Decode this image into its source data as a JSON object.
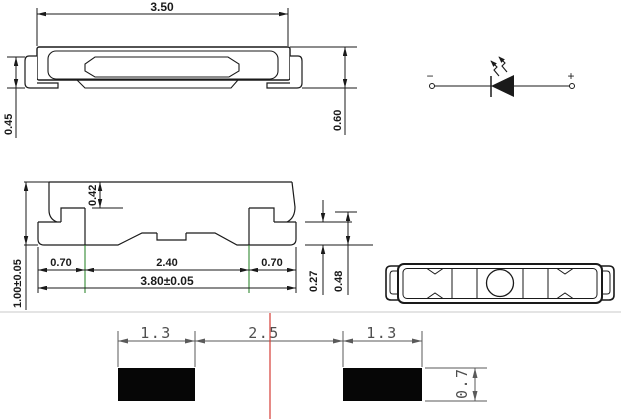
{
  "colors": {
    "line": "#1a1a1a",
    "dim_gray": "#5a5a5a",
    "red_centerline": "#d63c35",
    "green_extension": "#1e7d1e",
    "divider_gray": "#c9c9c9",
    "pad_black": "#060606",
    "background": "#ffffff"
  },
  "side_view": {
    "width": "3.50",
    "lead_height": "0.45",
    "total_height": "0.60"
  },
  "schematic": {
    "cathode_sign": "−",
    "anode_sign": "+"
  },
  "cross_section": {
    "step_depth": "0.42",
    "overall_height": "1.00±0.05",
    "left_lead": "0.70",
    "center_span": "2.40",
    "right_lead": "0.70",
    "overall_width": "3.80±0.05",
    "standoff": "0.27",
    "lead_height": "0.48"
  },
  "land_pattern": {
    "left_pad_width": "1.3",
    "pad_gap": "2.5",
    "right_pad_width": "1.3",
    "pad_height": "0.7"
  }
}
